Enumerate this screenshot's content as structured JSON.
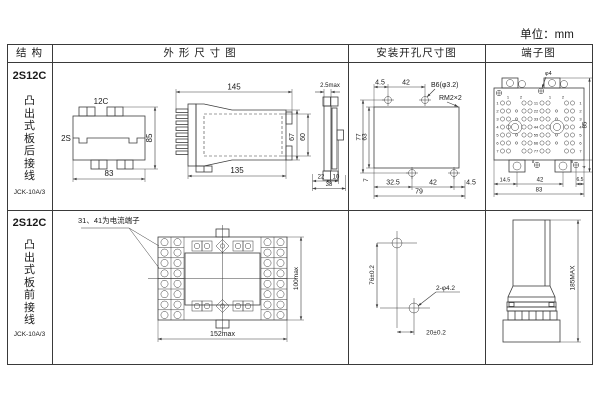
{
  "unit_label": "单位：mm",
  "headers": {
    "structure": "结 构",
    "outline": "外 形 尺 寸 图",
    "mounting": "安装开孔尺寸图",
    "terminal": "端子图"
  },
  "row1": {
    "model": "2S12C",
    "desc": "凸出式板后接线",
    "code": "JCK-10A/3",
    "front": {
      "top": "12C",
      "left": "2S",
      "right": "85",
      "bottom": "83"
    },
    "side": {
      "top": "145",
      "bottom": "135",
      "h1": "67",
      "h2": "60"
    },
    "rear": {
      "top": "2.5max",
      "b1": "22",
      "b2": "10",
      "b3": "38"
    },
    "mount": {
      "t1": "4.5",
      "t2": "42",
      "hole": "B6(φ3.2)",
      "thread": "RM2×2",
      "l1": "77",
      "l2": "63",
      "b0": "7",
      "b1": "32.5",
      "b2": "42",
      "b3": "4.5",
      "total": "79"
    },
    "term": {
      "phi": "φ4",
      "right": "85",
      "small": "4",
      "b1": "14.5",
      "b2": "42",
      "b3": "6.5",
      "total": "83",
      "top_nums": [
        "1",
        "2",
        "1",
        "2"
      ],
      "rows": [
        "1",
        "2",
        "3",
        "4",
        "5",
        "6",
        "7"
      ],
      "pairs": [
        "11",
        "22",
        "33",
        "44",
        "55",
        "66",
        "77"
      ],
      "eights": [
        "8",
        "8"
      ]
    }
  },
  "row2": {
    "model": "2S12C",
    "desc": "凸出式板前接线",
    "code": "JCK-10A/3",
    "note": "31、41为电流端子",
    "front": {
      "w": "152max",
      "h": "100max"
    },
    "mount": {
      "v": "76±0.2",
      "hole": "2-φ4.2",
      "h": "20±0.2"
    },
    "term": {
      "h": "185MAX"
    }
  }
}
